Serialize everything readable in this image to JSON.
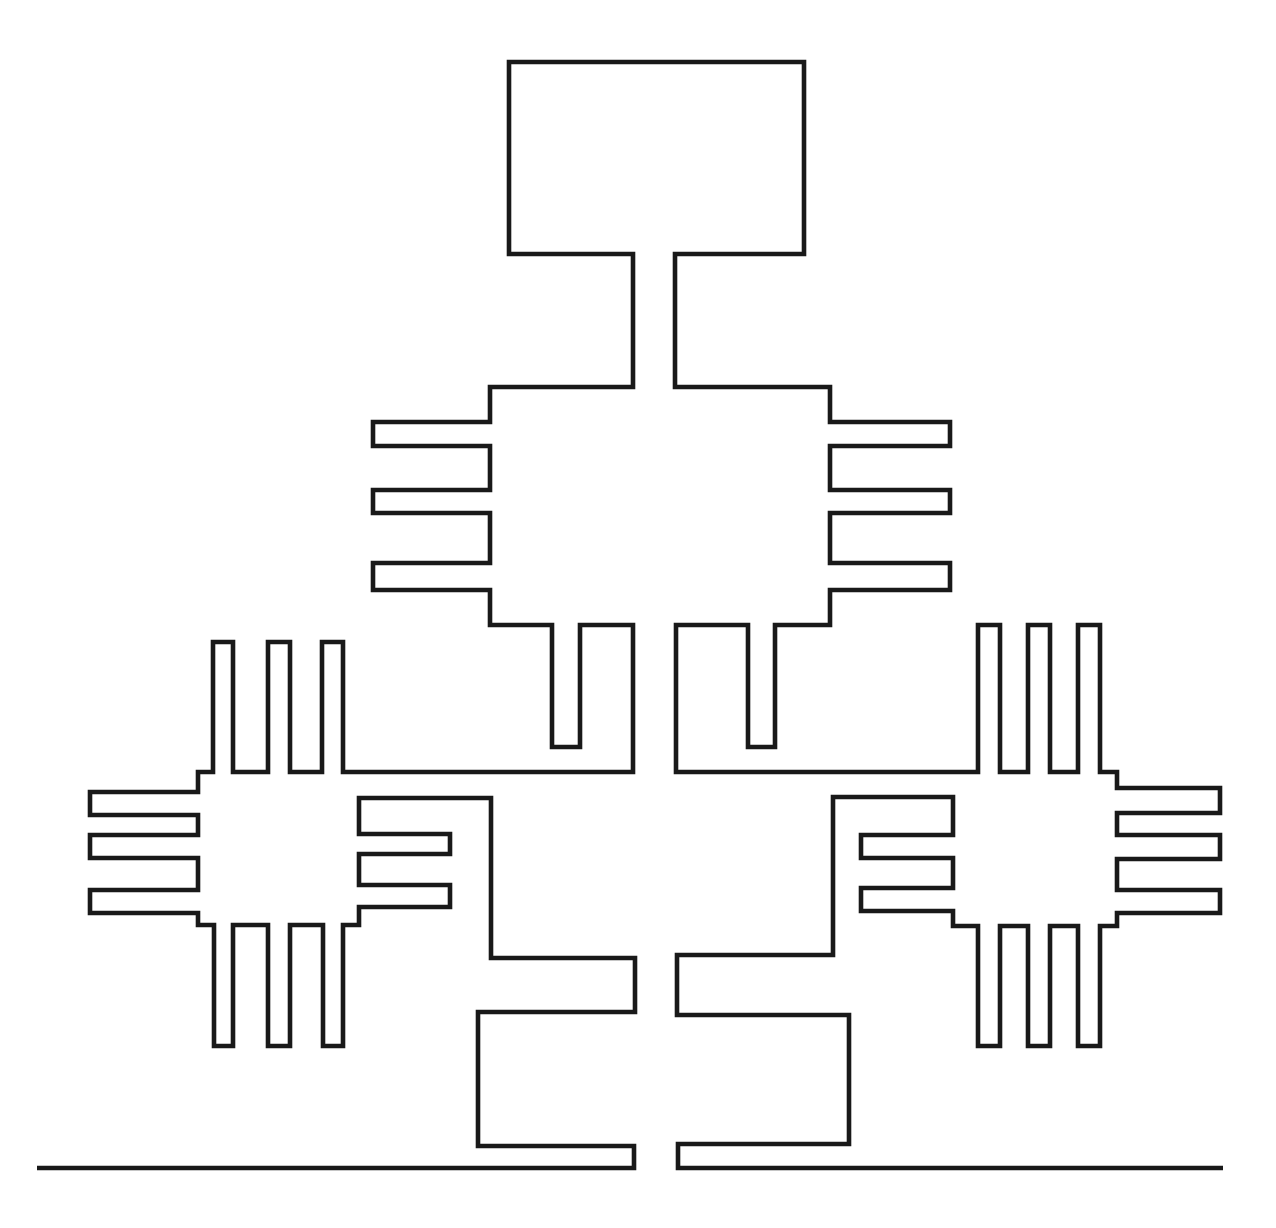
{
  "drawing": {
    "canvas_width": 1276,
    "canvas_height": 1228,
    "background_color": "#ffffff",
    "line_color": "#191919",
    "line_width": 4.6,
    "paths": [
      {
        "name": "structure-and-ground-outline",
        "closed": false,
        "points": [
          [
            37,
            1168
          ],
          [
            634,
            1168
          ],
          [
            634,
            1146
          ],
          [
            478,
            1146
          ],
          [
            478,
            1012
          ],
          [
            635,
            1012
          ],
          [
            635,
            958
          ],
          [
            491,
            958
          ],
          [
            491,
            798
          ],
          [
            359,
            798
          ],
          [
            359,
            834
          ],
          [
            450,
            834
          ],
          [
            450,
            854
          ],
          [
            359,
            854
          ],
          [
            359,
            885
          ],
          [
            450,
            885
          ],
          [
            450,
            907
          ],
          [
            359,
            907
          ],
          [
            359,
            925
          ],
          [
            343,
            925
          ],
          [
            343,
            1046
          ],
          [
            323,
            1046
          ],
          [
            323,
            925
          ],
          [
            290,
            925
          ],
          [
            290,
            1046
          ],
          [
            268,
            1046
          ],
          [
            268,
            925
          ],
          [
            233,
            925
          ],
          [
            233,
            1046
          ],
          [
            214,
            1046
          ],
          [
            214,
            925
          ],
          [
            198,
            925
          ],
          [
            198,
            913
          ],
          [
            90,
            913
          ],
          [
            90,
            890
          ],
          [
            198,
            890
          ],
          [
            198,
            858
          ],
          [
            90,
            858
          ],
          [
            90,
            835
          ],
          [
            198,
            835
          ],
          [
            198,
            815
          ],
          [
            90,
            815
          ],
          [
            90,
            792
          ],
          [
            198,
            792
          ],
          [
            198,
            772
          ],
          [
            213,
            772
          ],
          [
            213,
            642
          ],
          [
            233,
            642
          ],
          [
            233,
            772
          ],
          [
            268,
            772
          ],
          [
            268,
            642
          ],
          [
            290,
            642
          ],
          [
            290,
            772
          ],
          [
            322,
            772
          ],
          [
            322,
            642
          ],
          [
            343,
            642
          ],
          [
            343,
            772
          ],
          [
            633,
            772
          ],
          [
            633,
            625
          ],
          [
            580,
            625
          ],
          [
            580,
            747
          ],
          [
            552,
            747
          ],
          [
            552,
            625
          ],
          [
            490,
            625
          ],
          [
            490,
            590
          ],
          [
            373,
            590
          ],
          [
            373,
            563
          ],
          [
            490,
            563
          ],
          [
            490,
            513
          ],
          [
            373,
            513
          ],
          [
            373,
            490
          ],
          [
            490,
            490
          ],
          [
            490,
            446
          ],
          [
            373,
            446
          ],
          [
            373,
            422
          ],
          [
            490,
            422
          ],
          [
            490,
            387
          ],
          [
            633,
            387
          ],
          [
            633,
            254
          ],
          [
            509,
            254
          ],
          [
            509,
            62
          ],
          [
            804,
            62
          ],
          [
            804,
            254
          ],
          [
            675,
            254
          ],
          [
            675,
            387
          ],
          [
            830,
            387
          ],
          [
            830,
            422
          ],
          [
            950,
            422
          ],
          [
            950,
            446
          ],
          [
            830,
            446
          ],
          [
            830,
            490
          ],
          [
            950,
            490
          ],
          [
            950,
            513
          ],
          [
            830,
            513
          ],
          [
            830,
            563
          ],
          [
            950,
            563
          ],
          [
            950,
            590
          ],
          [
            830,
            590
          ],
          [
            830,
            625
          ],
          [
            775,
            625
          ],
          [
            775,
            747
          ],
          [
            748,
            747
          ],
          [
            748,
            625
          ],
          [
            676,
            625
          ],
          [
            676,
            772
          ],
          [
            978,
            772
          ],
          [
            978,
            625
          ],
          [
            1000,
            625
          ],
          [
            1000,
            772
          ],
          [
            1028,
            772
          ],
          [
            1028,
            625
          ],
          [
            1050,
            625
          ],
          [
            1050,
            772
          ],
          [
            1078,
            772
          ],
          [
            1078,
            625
          ],
          [
            1100,
            625
          ],
          [
            1100,
            772
          ],
          [
            1117,
            772
          ],
          [
            1117,
            788
          ],
          [
            1220,
            788
          ],
          [
            1220,
            813
          ],
          [
            1117,
            813
          ],
          [
            1117,
            835
          ],
          [
            1220,
            835
          ],
          [
            1220,
            859
          ],
          [
            1117,
            859
          ],
          [
            1117,
            890
          ],
          [
            1220,
            890
          ],
          [
            1220,
            913
          ],
          [
            1117,
            913
          ],
          [
            1117,
            926
          ],
          [
            1100,
            926
          ],
          [
            1100,
            1046
          ],
          [
            1078,
            1046
          ],
          [
            1078,
            926
          ],
          [
            1050,
            926
          ],
          [
            1050,
            1046
          ],
          [
            1028,
            1046
          ],
          [
            1028,
            926
          ],
          [
            1000,
            926
          ],
          [
            1000,
            1046
          ],
          [
            978,
            1046
          ],
          [
            978,
            926
          ],
          [
            953,
            926
          ],
          [
            953,
            911
          ],
          [
            861,
            911
          ],
          [
            861,
            888
          ],
          [
            953,
            888
          ],
          [
            953,
            858
          ],
          [
            861,
            858
          ],
          [
            861,
            835
          ],
          [
            953,
            835
          ],
          [
            953,
            797
          ],
          [
            833,
            797
          ],
          [
            833,
            955
          ],
          [
            677,
            955
          ],
          [
            677,
            1015
          ],
          [
            849,
            1015
          ],
          [
            849,
            1144
          ],
          [
            678,
            1144
          ],
          [
            678,
            1168
          ],
          [
            1223,
            1168
          ]
        ]
      }
    ]
  }
}
